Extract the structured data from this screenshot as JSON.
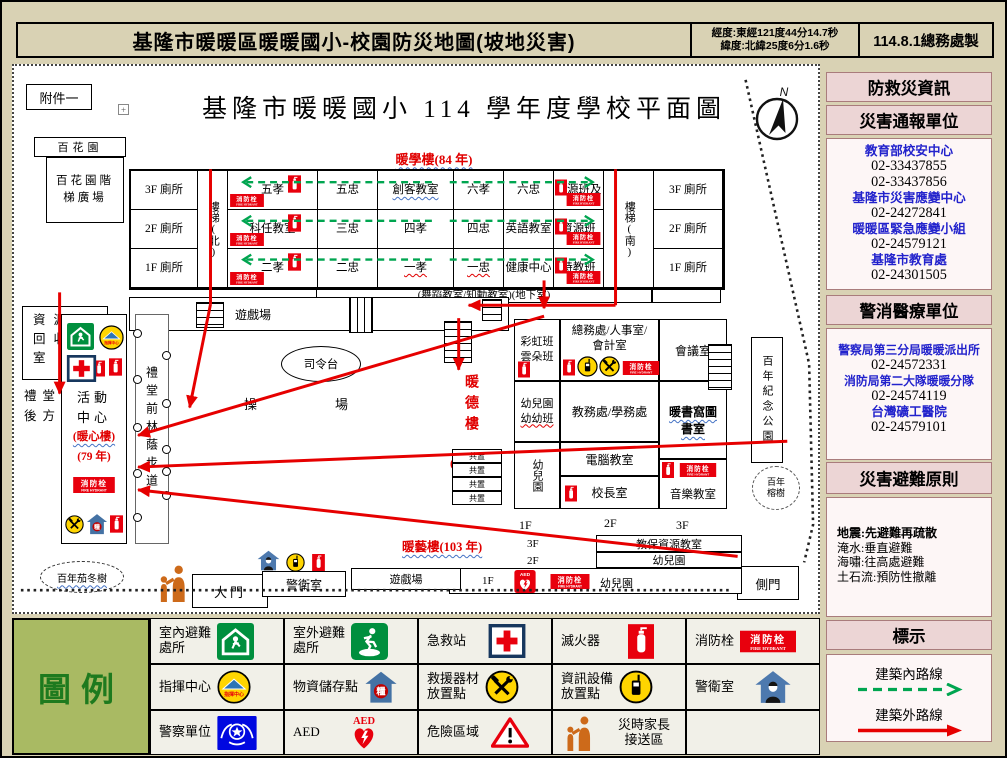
{
  "header": {
    "title": "基隆市暖暖區暖暖國小-校園防災地圖(坡地災害)",
    "coord_line1": "經度:東經121度44分14.7秒",
    "coord_line2": "緯度:北緯25度6分1.6秒",
    "credit": "114.8.1總務處製"
  },
  "map": {
    "attachment": "附件一",
    "anchor_mark": "+",
    "plan_title": "基隆市暖暖國小 114 學年度學校平面圖",
    "flower_garden": "百花園",
    "flower_garden_steps": "百花園階梯廣場",
    "bldg_nuanxue": "暖學樓(84 年)",
    "toilet_3f": "3F 廁所",
    "toilet_2f": "2F 廁所",
    "toilet_1f": "1F 廁所",
    "stair_north": "樓梯(北)",
    "stair_south": "樓梯(南)",
    "rooms_3f": [
      "五孝",
      "五忠",
      "創客教室",
      "六孝",
      "六忠",
      "資源班及"
    ],
    "rooms_2f": [
      "科任教室",
      "三忠",
      "四孝",
      "四忠",
      "英語教室",
      "資源班"
    ],
    "rooms_1f": [
      "二孝",
      "二忠",
      "一孝",
      "一忠",
      "健康中心",
      "特教班"
    ],
    "basement": "(舞蹈教室/知動教室)(地下室)",
    "play_area": "遊戲場",
    "stage": "司令台",
    "field": "操場",
    "bldg_nuande": "暖德樓",
    "bldg_nuande_year": "(75 年)",
    "east_building": {
      "a1": [
        "彩虹班",
        "雲朵班"
      ],
      "a2": [
        "幼兒園",
        "幼幼班"
      ],
      "a3": "幼兒園",
      "b1": "總務處/人事室/會計室",
      "b2": "教務處/學務處",
      "b3": "電腦教室",
      "b4": "校長室",
      "c1": "會議室",
      "c2": "暖書窩圖書室",
      "c3": "音樂教室",
      "floor_1f": "1F",
      "floor_2f": "2F",
      "floor_3f": "3F",
      "shared": "共置"
    },
    "park": "百年紀念公園",
    "banyan_l1": "百年",
    "banyan_l2": "榕樹",
    "side_gate": "側門",
    "bldg_nuanyi": "暖藝樓(103 年)",
    "nuanyi_3f": "3F",
    "nuanyi_2f": "2F",
    "nuanyi_1f": "1F",
    "care_room": "教保資源教室",
    "kinder_2f": "幼兒園",
    "kinder_1f": "幼兒園",
    "recycle_l1": "資源",
    "recycle_l2": "回收",
    "recycle_l3": "室",
    "hall_back_l1": "禮堂",
    "hall_back_l2": "後方",
    "activity_l1": "活動",
    "activity_l2": "中心",
    "activity_l3": "(暖心樓)",
    "activity_l4": "(79 年)",
    "tree_path": "禮堂前林蔭步道",
    "old_tree": "百年茄冬樹",
    "main_gate": "大門",
    "guard": "警衛室",
    "play_area2": "遊戲場"
  },
  "sidebar": {
    "title": "防救災資訊",
    "sec_report": "災害通報單位",
    "contacts": [
      {
        "name": "教育部校安中心",
        "phone1": "02-33437855",
        "phone2": "02-33437856"
      },
      {
        "name": "基隆市災害應變中心",
        "phone1": "02-24272841"
      },
      {
        "name": "暖暖區緊急應變小組",
        "phone1": "02-24579121"
      },
      {
        "name": "基隆市教育處",
        "phone1": "02-24301505"
      }
    ],
    "sec_police": "警消醫療單位",
    "responders": [
      {
        "name": "警察局第三分局暖暖派出所",
        "phone1": "02-24572331"
      },
      {
        "name": "消防局第二大隊暖暖分隊",
        "phone1": "02-24574119"
      },
      {
        "name": "台灣礦工醫院",
        "phone1": "02-24579101"
      }
    ],
    "sec_principles": "災害避難原則",
    "principles": [
      "地震:先避難再疏散",
      "淹水:垂直避難",
      "海嘯:往高處避難",
      "土石流:預防性撤離"
    ],
    "sec_marks": "標示",
    "route_inside": "建築內路線",
    "route_outside": "建築外路線"
  },
  "legend": {
    "title": "圖例",
    "items": [
      {
        "label": "室內避難\n處所"
      },
      {
        "label": "室外避難\n處所"
      },
      {
        "label": "急救站"
      },
      {
        "label": "滅火器"
      },
      {
        "label": "消防栓"
      },
      {
        "label": "指揮中心"
      },
      {
        "label": "物資儲存點"
      },
      {
        "label": "救援器材\n放置點"
      },
      {
        "label": "資訊設備\n放置點"
      },
      {
        "label": "警衛室"
      },
      {
        "label": "警察單位"
      },
      {
        "label": "AED"
      },
      {
        "label": "危險區域"
      },
      {
        "label": "災時家長\n接送區"
      },
      {
        "label": ""
      }
    ]
  },
  "icons": {
    "hydrant_zh": "消防栓",
    "hydrant_en": "FIRE HYDRANT",
    "aed": "AED",
    "command": "指揮中心",
    "supply": "糧",
    "north": "N"
  },
  "colors": {
    "route_outside": "#e60000",
    "route_inside": "#00a550",
    "building_label": "#e00000",
    "contact_blue": "#2222cc"
  }
}
